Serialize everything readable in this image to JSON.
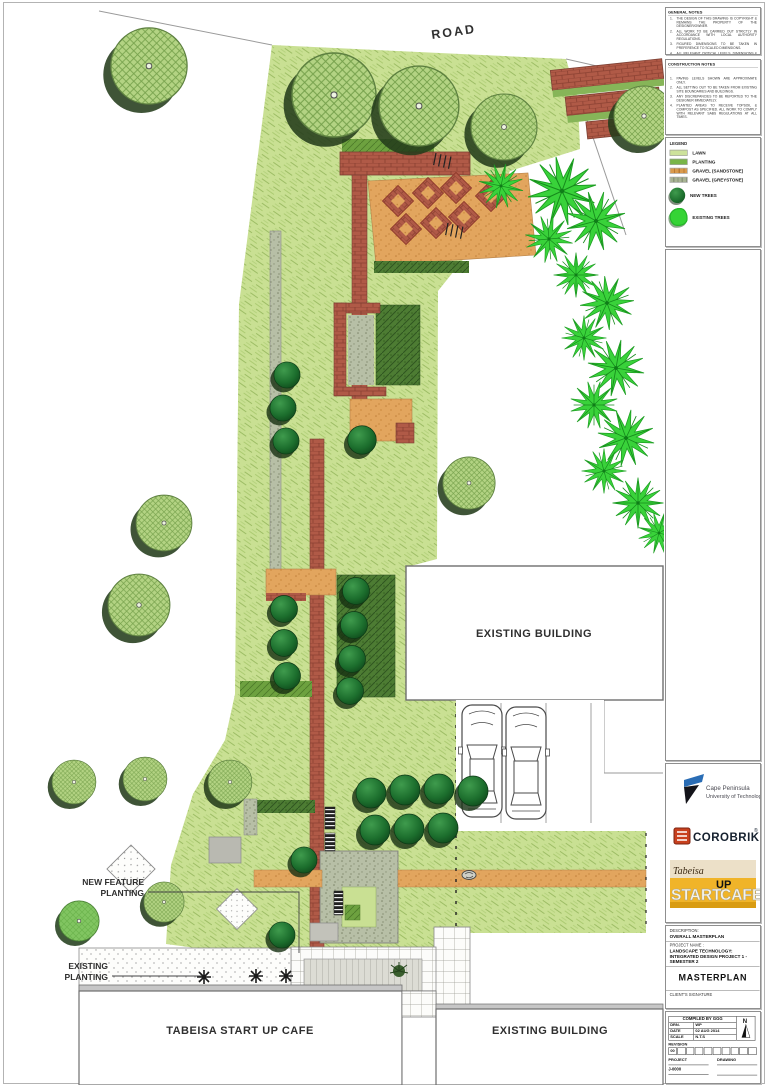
{
  "plan": {
    "road": "ROAD",
    "existing_building_mid": "EXISTING BUILDING",
    "existing_building_bottom": "EXISTING BUILDING",
    "tabeisa_cafe": "TABEISA START UP CAFE",
    "new_feature_planting": {
      "line1": "NEW FEATURE",
      "line2": "PLANTING"
    },
    "existing_planting": {
      "line1": "EXISTING",
      "line2": "PLANTING"
    }
  },
  "notes": {
    "general": {
      "title": "GENERAL NOTES",
      "items": [
        {
          "num": "1.",
          "text": "THE DESIGN OF THIS DRAWING IS COPYRIGHT & REMAINS THE PROPERTY OF THE DESIGNER/OWNER."
        },
        {
          "num": "2.",
          "text": "ALL WORK TO BE CARRIED OUT STRICTLY IN ACCORDANCE WITH LOCAL AUTHORITY REGULATIONS."
        },
        {
          "num": "3.",
          "text": "FIGURED DIMENSIONS TO BE TAKEN IN PREFERENCE TO SCALED DIMENSIONS."
        },
        {
          "num": "4.",
          "text": "ALL RELEVANT CRITICAL LEVELS, DIMENSIONS & SETTING OUT TO BE CHECKED ON SITE BEFORE COMMENCEMENT OF WORK."
        }
      ]
    },
    "construction": {
      "title": "CONSTRUCTION NOTES",
      "items": [
        {
          "num": "1.",
          "text": "PAVING LEVELS SHOWN ARE APPROXIMATE ONLY."
        },
        {
          "num": "2.",
          "text": "ALL SETTING OUT TO BE TAKEN FROM EXISTING SITE BOUNDARIES AND BUILDINGS."
        },
        {
          "num": "3.",
          "text": "ANY DISCREPANCIES TO BE REPORTED TO THE DESIGNER IMMEDIATELY."
        },
        {
          "num": "4.",
          "text": "PLANTED AREAS TO RECEIVE TOPSOIL & COMPOST AS SPECIFIED. ALL WORK TO COMPLY WITH RELEVANT SABS REGULATIONS AT ALL TIMES."
        }
      ]
    }
  },
  "legend": {
    "title": "LEGEND",
    "items": [
      {
        "label": "LAWN",
        "color": "#cde29b"
      },
      {
        "label": "PLANTING",
        "color": "#79b548"
      },
      {
        "label": "GRAVEL (SANDSTONE)",
        "color": "#d99a4e"
      },
      {
        "label": "GRAVEL (GREYSTONE)",
        "color": "#a8b394"
      },
      {
        "label": "NEW TREES",
        "color": "#1c6e2d"
      },
      {
        "label": "EXISTING TREES",
        "color": "#35d435"
      }
    ]
  },
  "logos": {
    "cput": {
      "line1": "Cape Peninsula",
      "line2": "University of Technology"
    },
    "corobrik": {
      "name": "COROBRIK",
      "reg": "®"
    },
    "tabeisa": {
      "brand": "Tabeisa",
      "word1": "START",
      "word2": "UP",
      "word3": "CAFE"
    }
  },
  "description": {
    "label": "DESCRIPTION:",
    "value": "OVERALL MASTERPLAN",
    "project_label": "PROJECT NAME :",
    "project_value": "LANDSCAPE TECHNOLOGY: INTEGRATED DESIGN PROJECT 1 - SEMESTER 2",
    "drawing_title": "MASTERPLAN",
    "signature_label": "CLIENT'S SIGNATURE"
  },
  "titleblock": {
    "compiled_by": "COMPILED BY  GGG",
    "rows": [
      {
        "label": "DRN.",
        "value": "WP"
      },
      {
        "label": "DATE",
        "value": "02 AUG 2014"
      },
      {
        "label": "SCALE",
        "value": "N.T.S"
      }
    ],
    "north": "N",
    "revision_label": "REVISION",
    "revision_first": "00",
    "project_label": "PROJECT",
    "drawing_label": "DRAWING",
    "number": "J-0000"
  },
  "colors": {
    "lawn": "#c9e093",
    "brick_path": "#b05a47",
    "sandstone": "#e2a55e",
    "greystone": "#b7bfa6",
    "new_tree": "#1c6e2d",
    "existing_tree": "#39d23a",
    "corobrik_text": "#15202e",
    "corobrik_icon": "#c8401e",
    "tabeisa_gold": "#f0b429"
  }
}
